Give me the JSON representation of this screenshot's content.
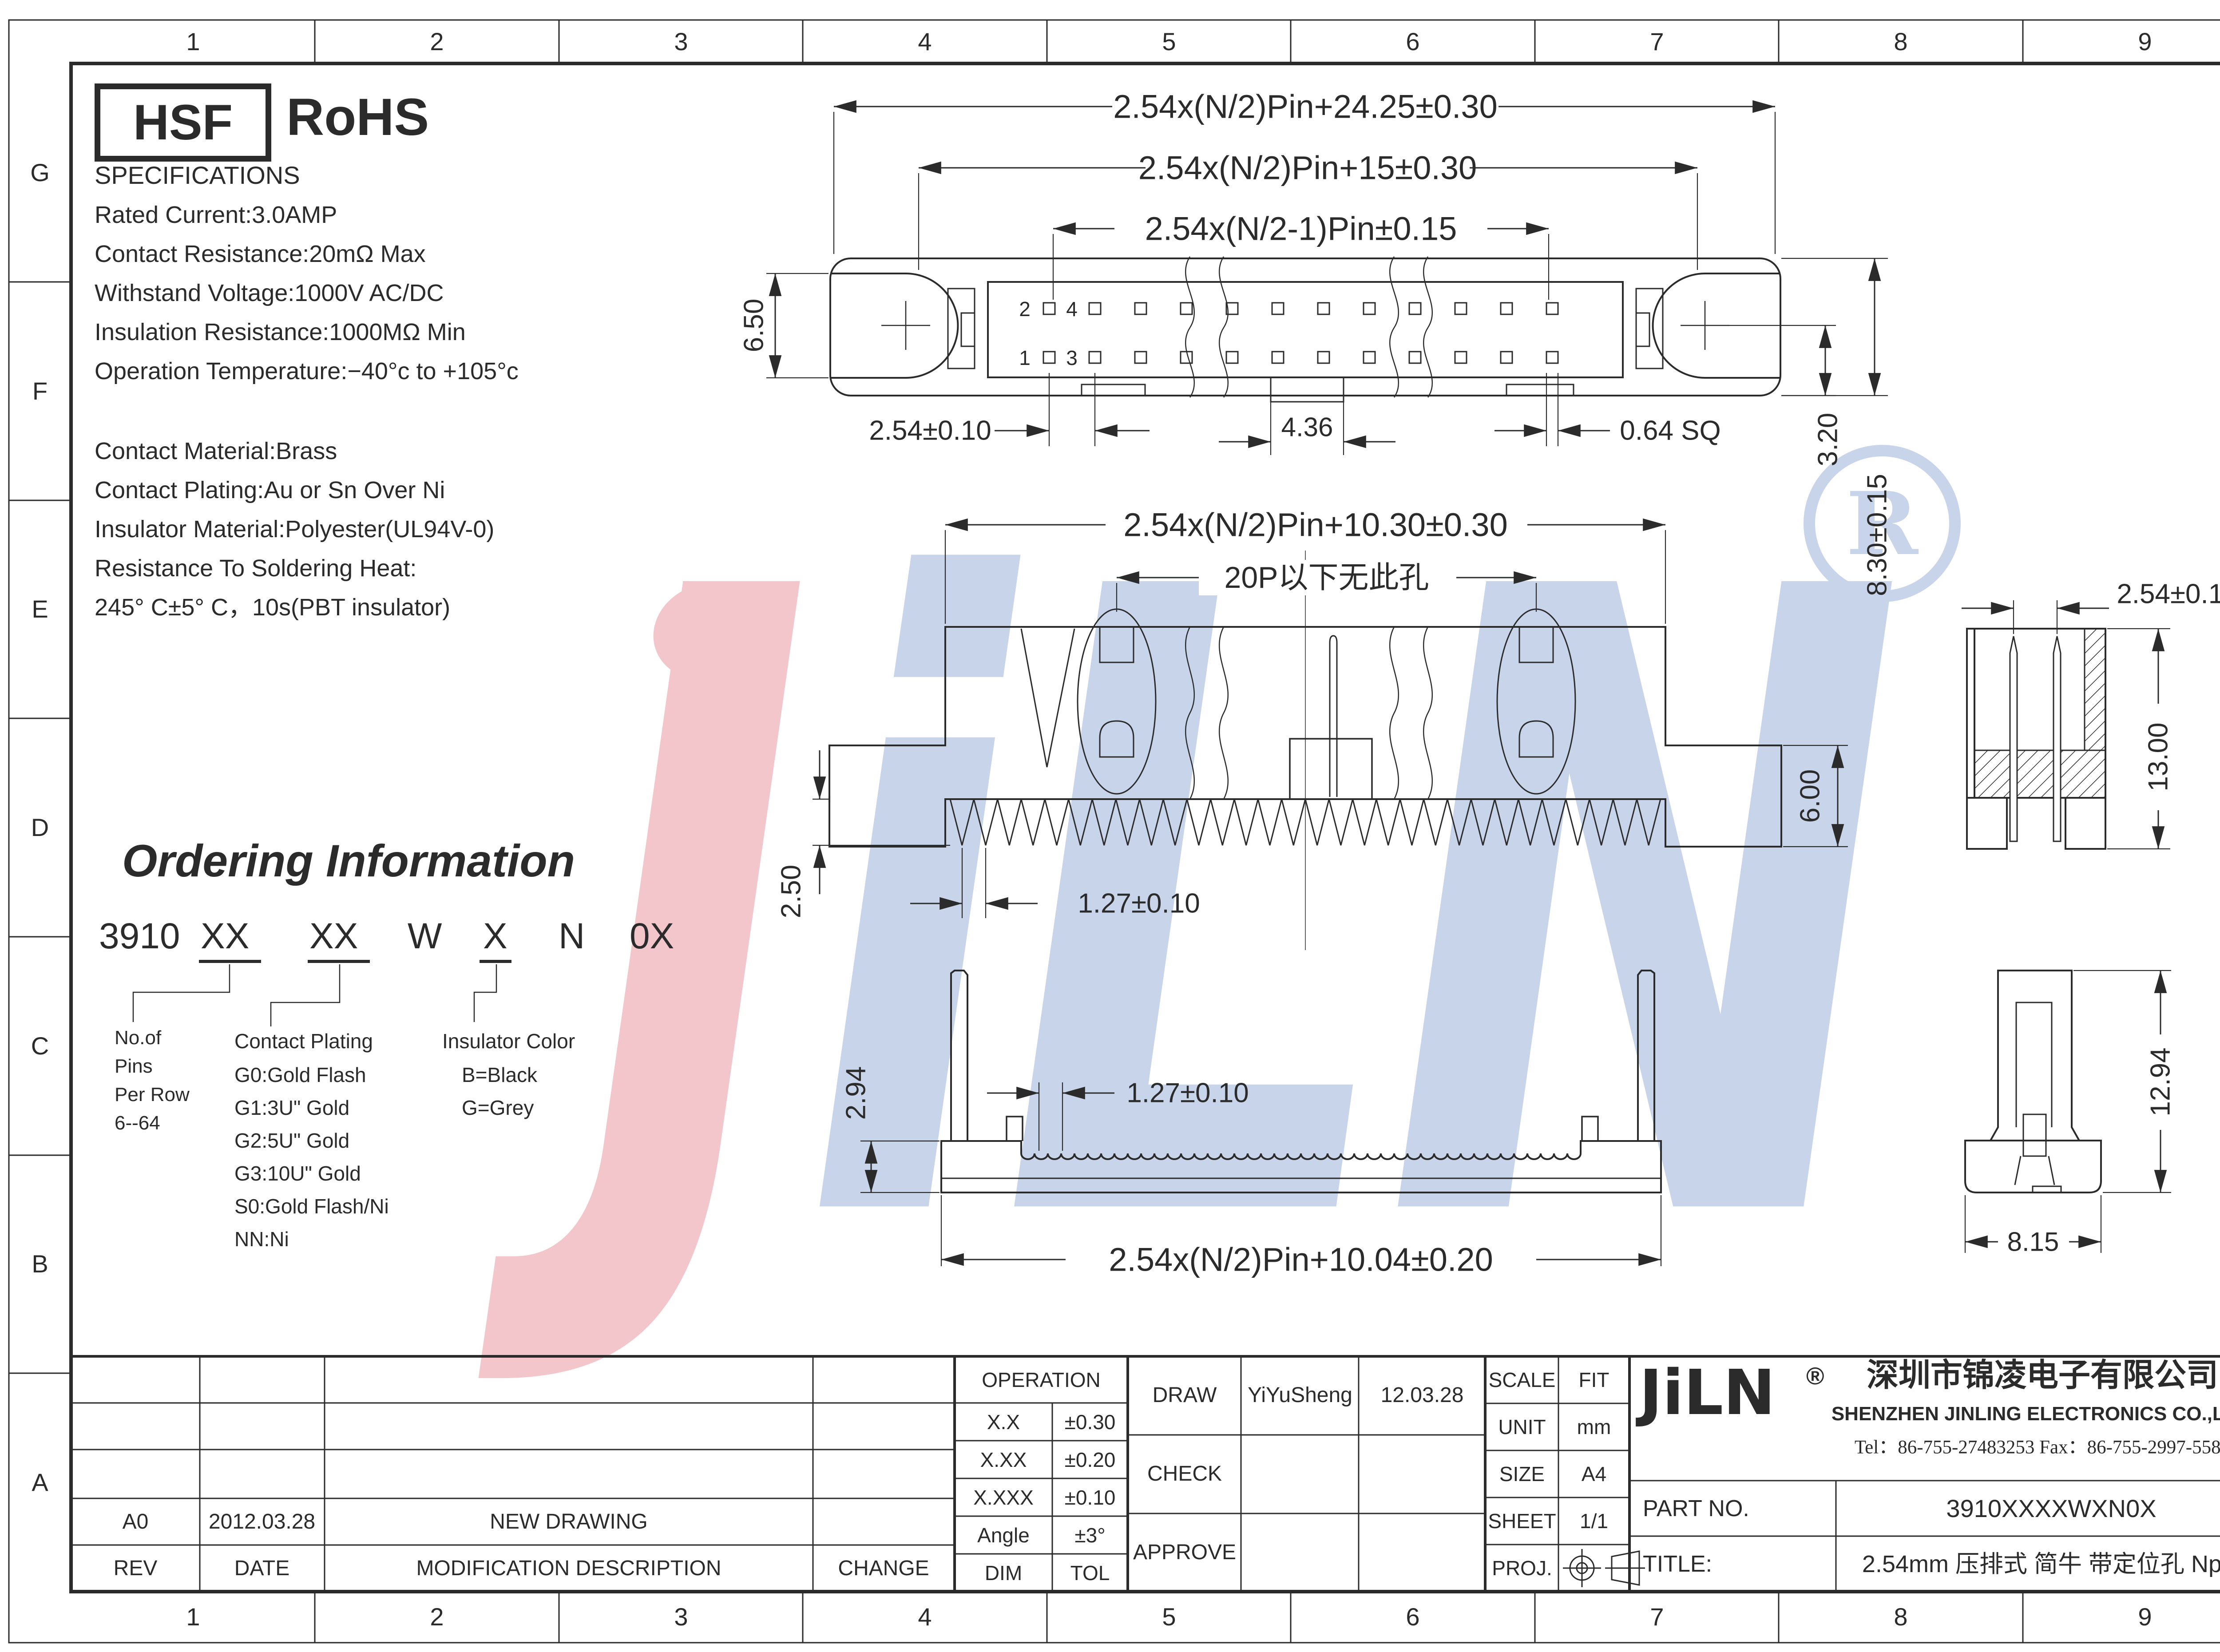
{
  "grid": {
    "cols": [
      "1",
      "2",
      "3",
      "4",
      "5",
      "6",
      "7",
      "8",
      "9"
    ],
    "rows": [
      "G",
      "F",
      "E",
      "D",
      "C",
      "B",
      "A"
    ]
  },
  "cert": {
    "hsf": "HSF",
    "rohs": "RoHS"
  },
  "specs": {
    "title": "SPECIFICATIONS",
    "electrical": [
      "Rated Current:3.0AMP",
      "Contact Resistance:20mΩ Max",
      "Withstand Voltage:1000V AC/DC",
      "Insulation Resistance:1000MΩ Min",
      "Operation Temperature:−40°c to +105°c"
    ],
    "material": [
      "Contact Material:Brass",
      "Contact Plating:Au or Sn Over Ni",
      "Insulator Material:Polyester(UL94V-0)",
      "Resistance To Soldering Heat:",
      "245° C±5° C，10s(PBT insulator)"
    ]
  },
  "ordering": {
    "title": "Ordering Information",
    "code": [
      "3910",
      "XX",
      "XX",
      "W",
      "X",
      "N",
      "0X"
    ],
    "pins_label": [
      "No.of",
      "Pins",
      "Per Row",
      "6--64"
    ],
    "plating_title": "Contact Plating",
    "plating_items": [
      "G0:Gold Flash",
      "G1:3U\" Gold",
      "G2:5U\" Gold",
      "G3:10U\" Gold",
      "S0:Gold Flash/Ni",
      "NN:Ni"
    ],
    "color_title": "Insulator Color",
    "color_items": [
      "B=Black",
      "G=Grey"
    ]
  },
  "pins": {
    "p1": "1",
    "p2": "2",
    "p3": "3",
    "p4": "4"
  },
  "dims": {
    "top": {
      "overall": "2.54x(N/2)Pin+24.25±0.30",
      "flange": "2.54x(N/2)Pin+15±0.30",
      "pinspan": "2.54x(N/2-1)Pin±0.15",
      "pitch": "2.54±0.10",
      "notch": "4.36",
      "pinsq": "0.64 SQ",
      "sloth": "6.50",
      "offset": "3.20",
      "bodyh": "8.30±0.15"
    },
    "side": {
      "overall": "2.54x(N/2)Pin+10.30±0.30",
      "holenote": "20P以下无此孔",
      "pinpitch": "1.27±0.10",
      "pinlen": "2.50",
      "earh": "6.00"
    },
    "section": {
      "pitch": "2.54±0.10",
      "height": "13.00"
    },
    "bottom": {
      "baseh": "2.94",
      "pitch": "1.27±0.10",
      "overall": "2.54x(N/2)Pin+10.04±0.20"
    },
    "end": {
      "height": "12.94",
      "width": "8.15"
    }
  },
  "titleblock": {
    "operation": "OPERATION",
    "tol_rows": [
      [
        "X.X",
        "±0.30"
      ],
      [
        "X.XX",
        "±0.20"
      ],
      [
        "X.XXX",
        "±0.10"
      ],
      [
        "Angle",
        "±3°"
      ],
      [
        "DIM",
        "TOL"
      ]
    ],
    "draw": "DRAW",
    "check": "CHECK",
    "approve": "APPROVE",
    "drawer": "YiYuSheng",
    "draw_date": "12.03.28",
    "scale_label": "SCALE",
    "scale_value": "FIT",
    "unit_label": "UNIT",
    "unit_value": "mm",
    "size_label": "SIZE",
    "size_value": "A4",
    "sheet_label": "SHEET",
    "sheet_value": "1/1",
    "proj_label": "PROJ.",
    "logo": "JiLN",
    "logo_reg": "®",
    "company_cn": "深圳市锦凌电子有限公司",
    "company_en": "SHENZHEN JINLING ELECTRONICS CO.,LTD",
    "tel": "Tel：86-755-27483253 Fax：86-755-2997-5588",
    "part_label": "PART NO.",
    "part_value": "3910XXXXWXN0X",
    "title_label": "TITLE:",
    "title_value": "2.54mm 压排式 简牛 带定位孔 Npin"
  },
  "revisions": {
    "headers": [
      "REV",
      "DATE",
      "MODIFICATION DESCRIPTION",
      "CHANGE"
    ],
    "rows": [
      {
        "rev": "A0",
        "date": "2012.03.28",
        "desc": "NEW DRAWING",
        "change": ""
      }
    ]
  },
  "watermark": {
    "l1": "J",
    "l2": "i",
    "l3": "L",
    "l4": "N",
    "reg": "R"
  }
}
